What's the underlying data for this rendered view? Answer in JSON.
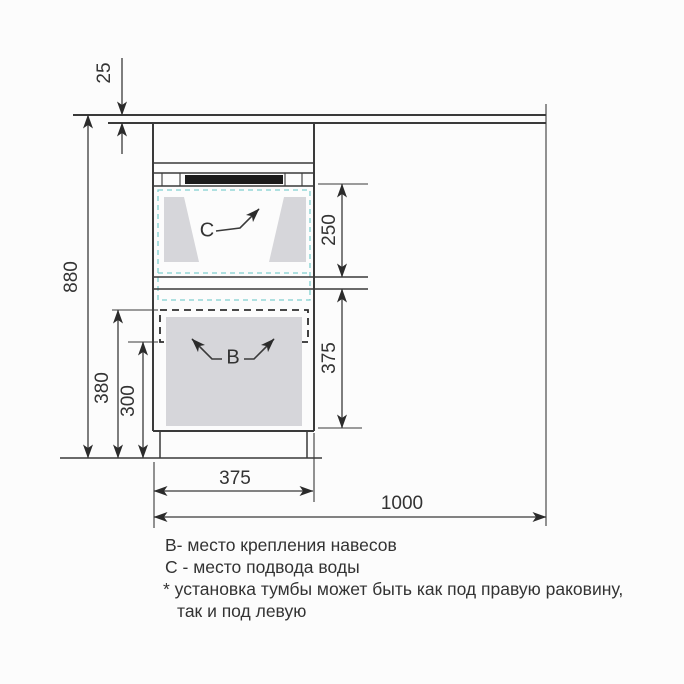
{
  "drawing": {
    "type": "vanity-cabinet-installation-front-view",
    "dims": {
      "countertop_thickness": "25",
      "total_height": "880",
      "hanger_zone_top_to_floor": "380",
      "hanger_zone_bottom_to_floor": "300",
      "sink_zone_height": "250",
      "door_zone_height": "375",
      "cabinet_width": "375",
      "total_width": "1000"
    },
    "callouts": {
      "hanger_mount": "В",
      "water_supply": "С"
    },
    "legend": {
      "line1": "В- место крепления навесов",
      "line2": "С - место подвода воды",
      "line3": "* установка тумбы может быть как под правую раковину,",
      "line4": "так и под левую"
    },
    "colors": {
      "line": "#3a3a3a",
      "sink_outline": "#7fcfcf",
      "panel_fill": "#d6d6da",
      "handle_fill": "#1b1b1b",
      "background": "#fcfcfc"
    }
  }
}
